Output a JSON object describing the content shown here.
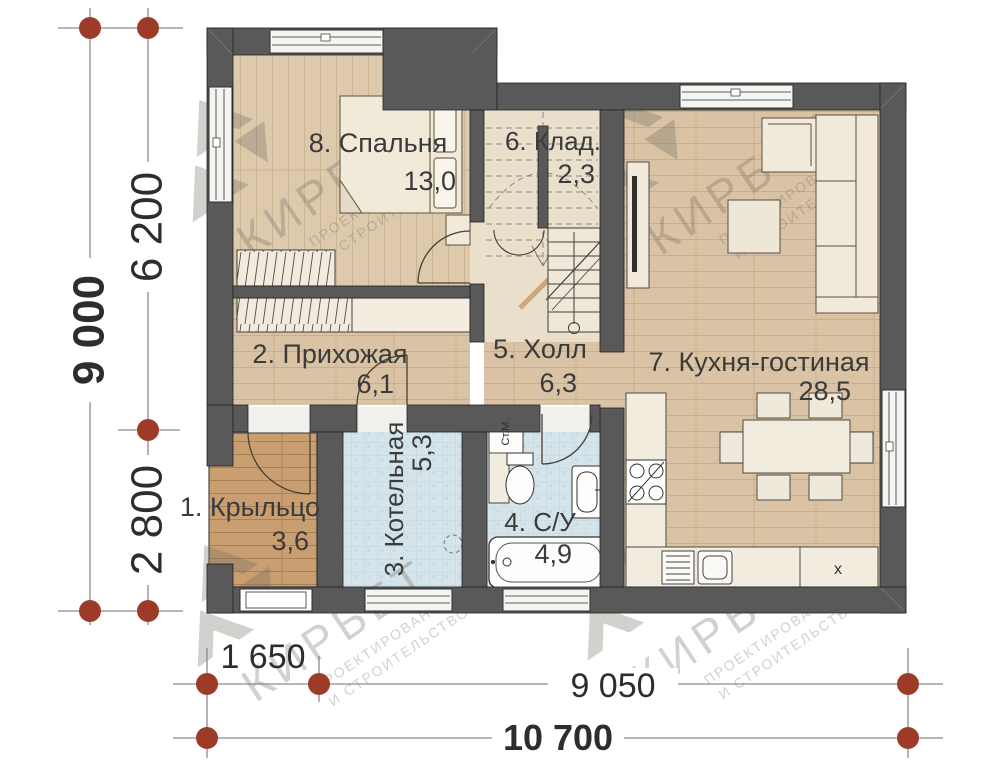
{
  "plan": {
    "rooms": {
      "porch": {
        "name": "1. Крыльцо",
        "area": "3,6"
      },
      "hallway": {
        "name": "2. Прихожая",
        "area": "6,1"
      },
      "boiler": {
        "name": "3. Котельная",
        "area": "5,3"
      },
      "bathroom": {
        "name": "4. С/У",
        "area": "4,9"
      },
      "hall": {
        "name": "5. Холл",
        "area": "6,3"
      },
      "storage": {
        "name": "6. Клад.",
        "area": "2,3"
      },
      "kitchen_living": {
        "name": "7. Кухня-гостиная",
        "area": "28,5"
      },
      "bedroom": {
        "name": "8. Спальня",
        "area": "13,0"
      }
    },
    "fixtures": {
      "washing_machine": "Ст.М.",
      "fridge_mark": "x"
    },
    "dimensions": {
      "total_height": "9 000",
      "upper_height": "6 200",
      "lower_height": "2 800",
      "porch_width": "1 650",
      "main_width": "9 050",
      "total_width": "10 700"
    },
    "watermark": {
      "brand": "КИРБЕТ",
      "line1": "ПРОЕКТИРОВАНИЕ",
      "line2": "И СТРОИТЕЛЬСТВО"
    },
    "colors": {
      "wall": "#59595a",
      "axis_marker": "#9e3b28",
      "wood_floor": "#d9c3a4",
      "porch_floor": "#c99f72",
      "tile_floor": "#d4e4ea",
      "storage_floor": "#eadfca"
    }
  }
}
